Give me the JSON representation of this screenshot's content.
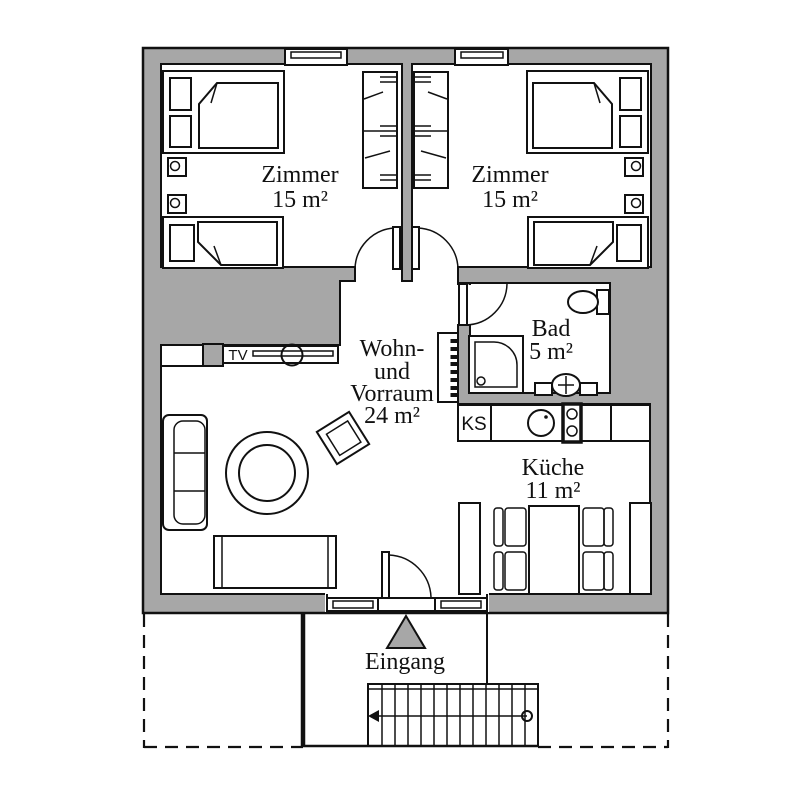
{
  "rooms": {
    "zimmer1": {
      "label": "Zimmer",
      "area": "15 m²"
    },
    "zimmer2": {
      "label": "Zimmer",
      "area": "15 m²"
    },
    "wohn_vorraum": {
      "line1": "Wohn-",
      "line2": "und",
      "line3": "Vorraum",
      "area": "24 m²"
    },
    "bad": {
      "label": "Bad",
      "area": "5 m²"
    },
    "kueche": {
      "label": "Küche",
      "area": "11 m²"
    }
  },
  "annotations": {
    "entrance": "Eingang",
    "tv_unit": "TV",
    "fridge": "KS"
  },
  "colors": {
    "wall_fill": "#a7a7a7",
    "line": "#111111",
    "background": "#ffffff"
  }
}
